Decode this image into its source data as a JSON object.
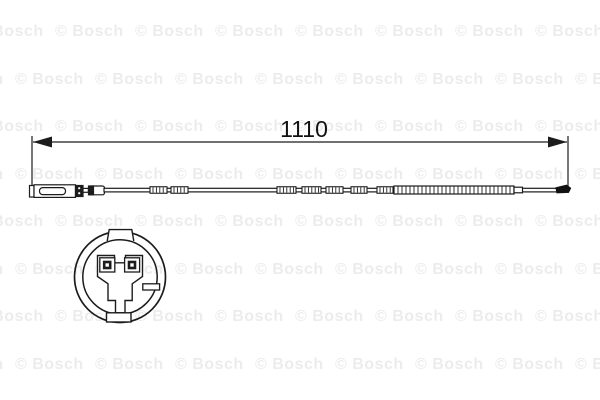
{
  "watermark": {
    "text": "© Bosch",
    "color": "#ececec"
  },
  "drawing": {
    "dimension_label": "1110",
    "line_color": "#1c1c1c",
    "background_color": "#ffffff",
    "parts": {
      "side_view": "brake-pad-wear-sensor-cable",
      "face_view": "connector-plug-face"
    }
  }
}
